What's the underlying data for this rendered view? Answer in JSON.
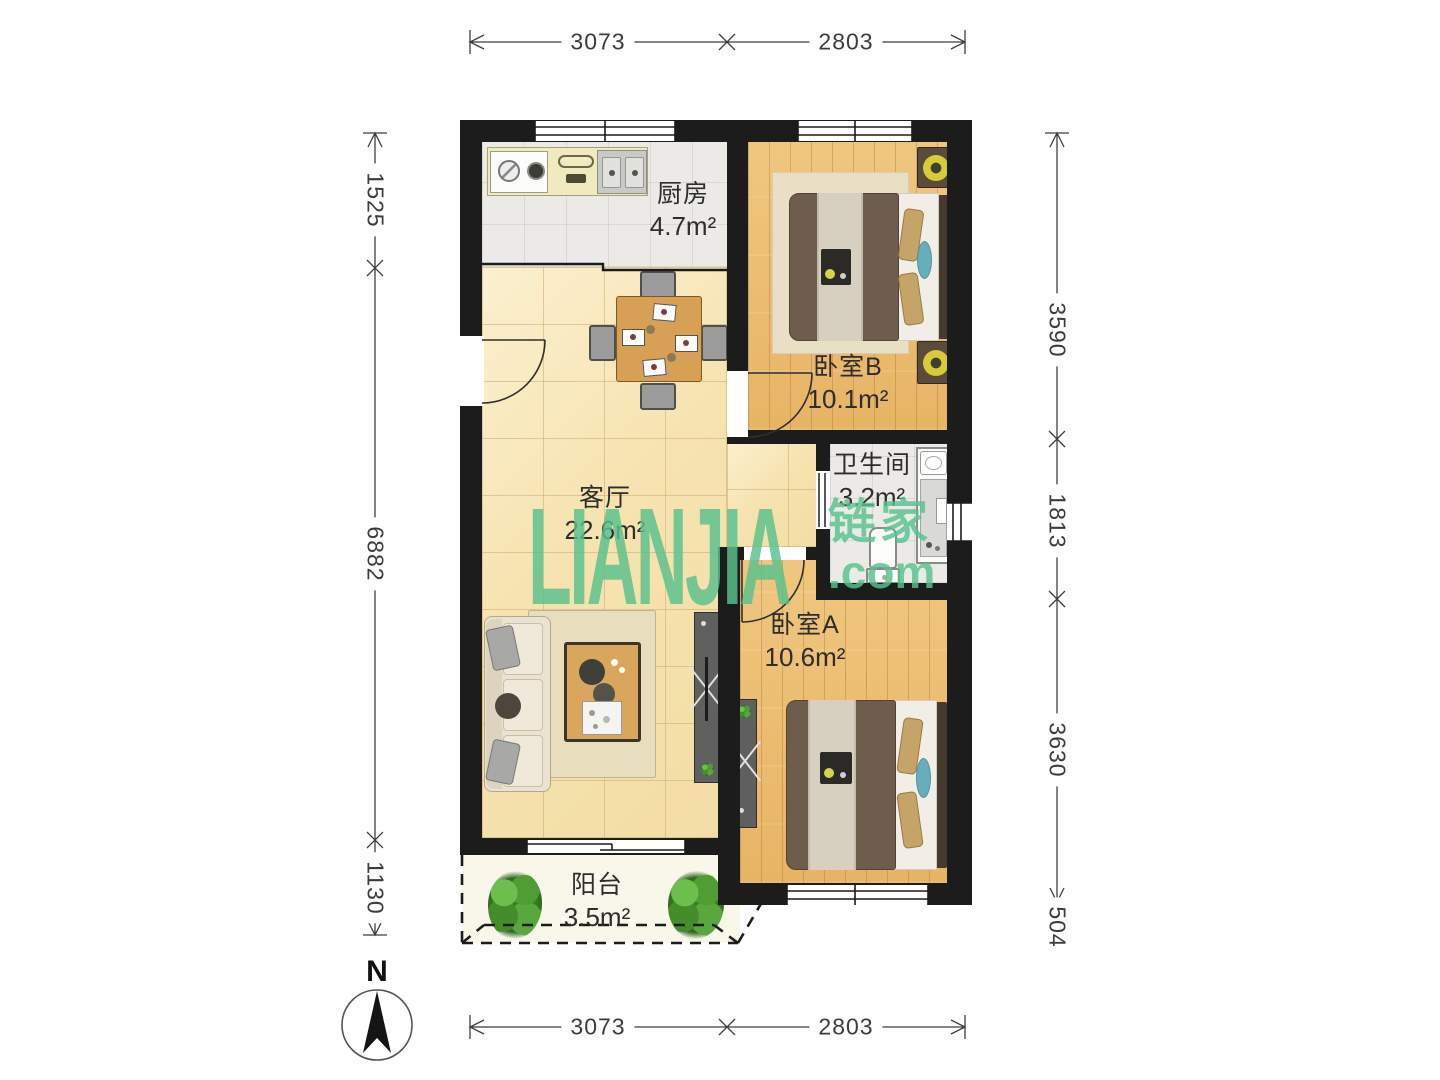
{
  "canvas": {
    "width": 1440,
    "height": 1080,
    "background": "#ffffff"
  },
  "watermark": {
    "brand": "LIANJIA",
    "cjk": "链家",
    "tld": ".com",
    "color": "#58c28e"
  },
  "compass": {
    "label": "N"
  },
  "rooms": [
    {
      "name": "厨房",
      "area": "4.7m²"
    },
    {
      "name": "卧室B",
      "area": "10.1m²"
    },
    {
      "name": "卫生间",
      "area": "3.2m²"
    },
    {
      "name": "客厅",
      "area": "22.6m²"
    },
    {
      "name": "卧室A",
      "area": "10.6m²"
    },
    {
      "name": "阳台",
      "area": "3.5m²"
    }
  ],
  "dimensions": {
    "top": [
      "3073",
      "2803"
    ],
    "bottom": [
      "3073",
      "2803"
    ],
    "left": [
      "1525",
      "6882",
      "1130"
    ],
    "right": [
      "3590",
      "1813",
      "3630",
      "504"
    ]
  },
  "colors": {
    "wall": "#1c1c1c",
    "wood_floor": "#eec178",
    "living_tile": "#f7e6ba",
    "wet_tile": "#eceae6",
    "balcony_floor": "#f8f7ea",
    "watermark_green": "#58c28e",
    "lamp_yellow": "#d9cb35",
    "pillow_teal": "#66aebc",
    "plant_green": "#4e9f33"
  }
}
